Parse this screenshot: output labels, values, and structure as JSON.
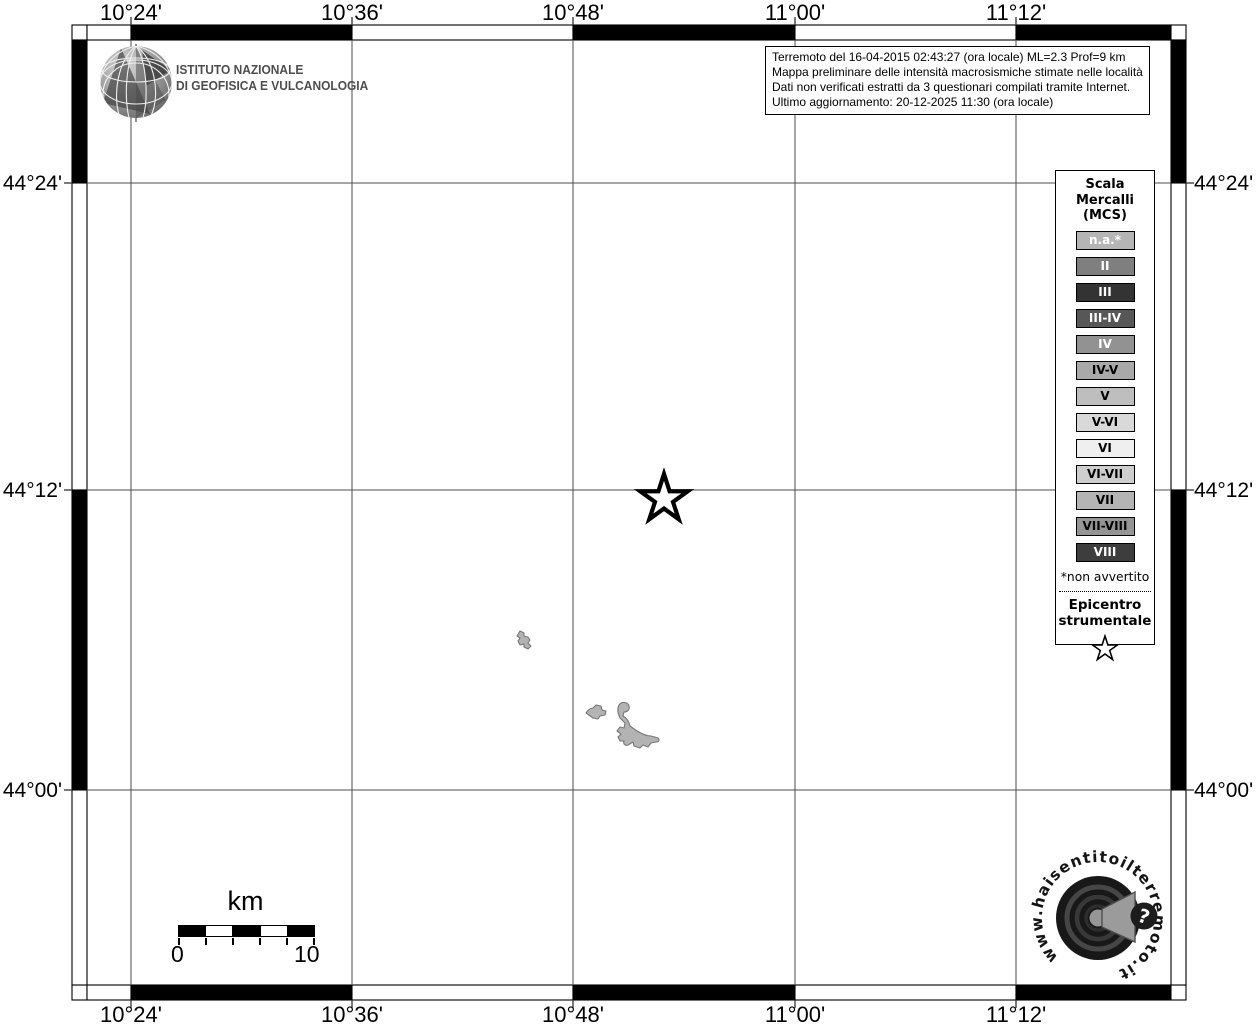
{
  "ingv_logo": {
    "line1": "ISTITUTO NAZIONALE",
    "line2": "DI GEOFISICA E VULCANOLOGIA"
  },
  "info_box": {
    "lines": [
      "Terremoto del 16-04-2015 02:43:27 (ora locale) ML=2.3 Prof=9 km",
      "Mappa preliminare delle intensità macrosismiche stimate nelle località",
      "Dati non verificati estratti da 3 questionari compilati tramite Internet.",
      "Ultimo aggiornamento: 20-12-2025 11:30 (ora locale)"
    ]
  },
  "axes": {
    "top": [
      "10°24'",
      "10°36'",
      "10°48'",
      "11°00'",
      "11°12'"
    ],
    "bottom": [
      "10°24'",
      "10°36'",
      "10°48'",
      "11°00'",
      "11°12'"
    ],
    "left": [
      "44°24'",
      "44°12'",
      "44°00'"
    ],
    "right": [
      "44°24'",
      "44°12'",
      "44°00'"
    ]
  },
  "legend": {
    "title_lines": [
      "Scala",
      "Mercalli",
      "(MCS)"
    ],
    "items": [
      {
        "label": "n.a.*",
        "fill": "#b5b5b5",
        "text_color": "#ffffff"
      },
      {
        "label": "II",
        "fill": "#7f7f7f",
        "text_color": "#ffffff"
      },
      {
        "label": "III",
        "fill": "#333333",
        "text_color": "#ffffff"
      },
      {
        "label": "III-IV",
        "fill": "#575757",
        "text_color": "#ffffff"
      },
      {
        "label": "IV",
        "fill": "#929292",
        "text_color": "#ffffff"
      },
      {
        "label": "IV-V",
        "fill": "#a9a9a9",
        "text_color": "#000000"
      },
      {
        "label": "V",
        "fill": "#bebebe",
        "text_color": "#000000"
      },
      {
        "label": "V-VI",
        "fill": "#d9d9d9",
        "text_color": "#000000"
      },
      {
        "label": "VI",
        "fill": "#efefef",
        "text_color": "#000000"
      },
      {
        "label": "VI-VII",
        "fill": "#cecece",
        "text_color": "#000000"
      },
      {
        "label": "VII",
        "fill": "#b4b4b4",
        "text_color": "#000000"
      },
      {
        "label": "VII-VIII",
        "fill": "#959595",
        "text_color": "#000000"
      },
      {
        "label": "VIII",
        "fill": "#3d3d3d",
        "text_color": "#ffffff"
      }
    ],
    "footnote": "*non avvertito",
    "epicenter_lines": [
      "Epicentro",
      "strumentale"
    ]
  },
  "scale_bar": {
    "unit": "km",
    "start": "0",
    "end": "10"
  },
  "site_logo": {
    "text": "www.haisentitoilterremoto.it",
    "question_mark": "?"
  },
  "map": {
    "epicenter_approx": {
      "lon": "10°53'",
      "lat": "44°11.7'"
    },
    "colors": {
      "frame_black": "#000000",
      "grid_line": "#4d4d4d",
      "locality_fill": "#b3b3b3",
      "locality_stroke": "#777777"
    }
  }
}
